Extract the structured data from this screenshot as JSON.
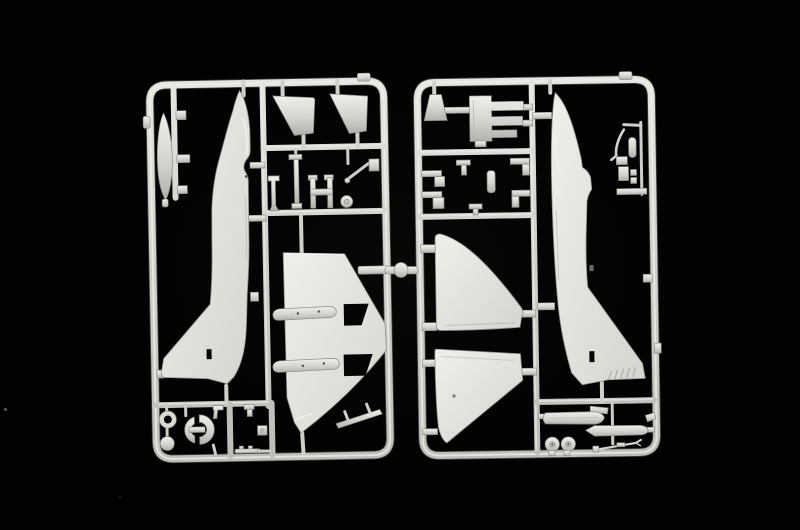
{
  "scene": {
    "kind": "photograph",
    "subject": "Two light-grey injection-moulded polystyrene sprues holding unassembled jet-aircraft model kit parts (fuselage halves, one-piece delta wing, upper wing panels, fin halves, external fuel tanks, landing gear, wheels, refuelling probe), photographed on a black background",
    "colors": {
      "background": "#020202",
      "glow": "#242422",
      "plastic_light": "#f0efea",
      "plastic_mid": "#d6d4ce",
      "plastic_dark": "#b3b1ab",
      "rail_light": "#e9e7e2",
      "rail_mid": "#d0cec8",
      "rail_dark": "#bdbbb5",
      "cutout": "#050505",
      "speck_warm": "#8d8274",
      "speck_gray": "#5a5a58"
    }
  },
  "sprue_left": {
    "id": "frame-a",
    "parts": [
      "external-fuel-tank",
      "runner-detail-nubs",
      "fuselage-left-half",
      "fin-half-a",
      "fin-half-b",
      "nose-gear-strut",
      "main-gear-strut",
      "gear-frame",
      "small-wheel",
      "actuator-arm",
      "actuator-block",
      "one-piece-lower-wing",
      "slat-cutout-a",
      "slat-cutout-b",
      "leading-edge-slat-a",
      "leading-edge-slat-b",
      "edge-strip",
      "tire-ring",
      "hub-disc",
      "intake-lip-half-a",
      "intake-lip-half-b",
      "pitot-part",
      "clip-part",
      "hatch-square",
      "cannon-strip"
    ]
  },
  "sprue_right": {
    "id": "frame-b",
    "parts": [
      "exhaust-pipe",
      "ejection-seat",
      "fuselage-right-half",
      "arresting-hook",
      "tail-bullet",
      "hook-bracket-a",
      "hook-bracket-b",
      "door-bracket-a",
      "door-bracket-b",
      "tee-part",
      "cockpit-bar",
      "side-bracket-a",
      "side-bracket-b",
      "small-clip",
      "upper-wing-half-a",
      "upper-wing-half-b",
      "drop-tank-half-a",
      "drop-tank-half-b",
      "tank-fin",
      "main-wheel-a",
      "main-wheel-b",
      "refueling-probe",
      "rail-nub-a",
      "rail-nub-b"
    ]
  },
  "artifacts": {
    "sprue_connector": "round joining nub between the two frames at mid height",
    "dust_specks": 3
  }
}
